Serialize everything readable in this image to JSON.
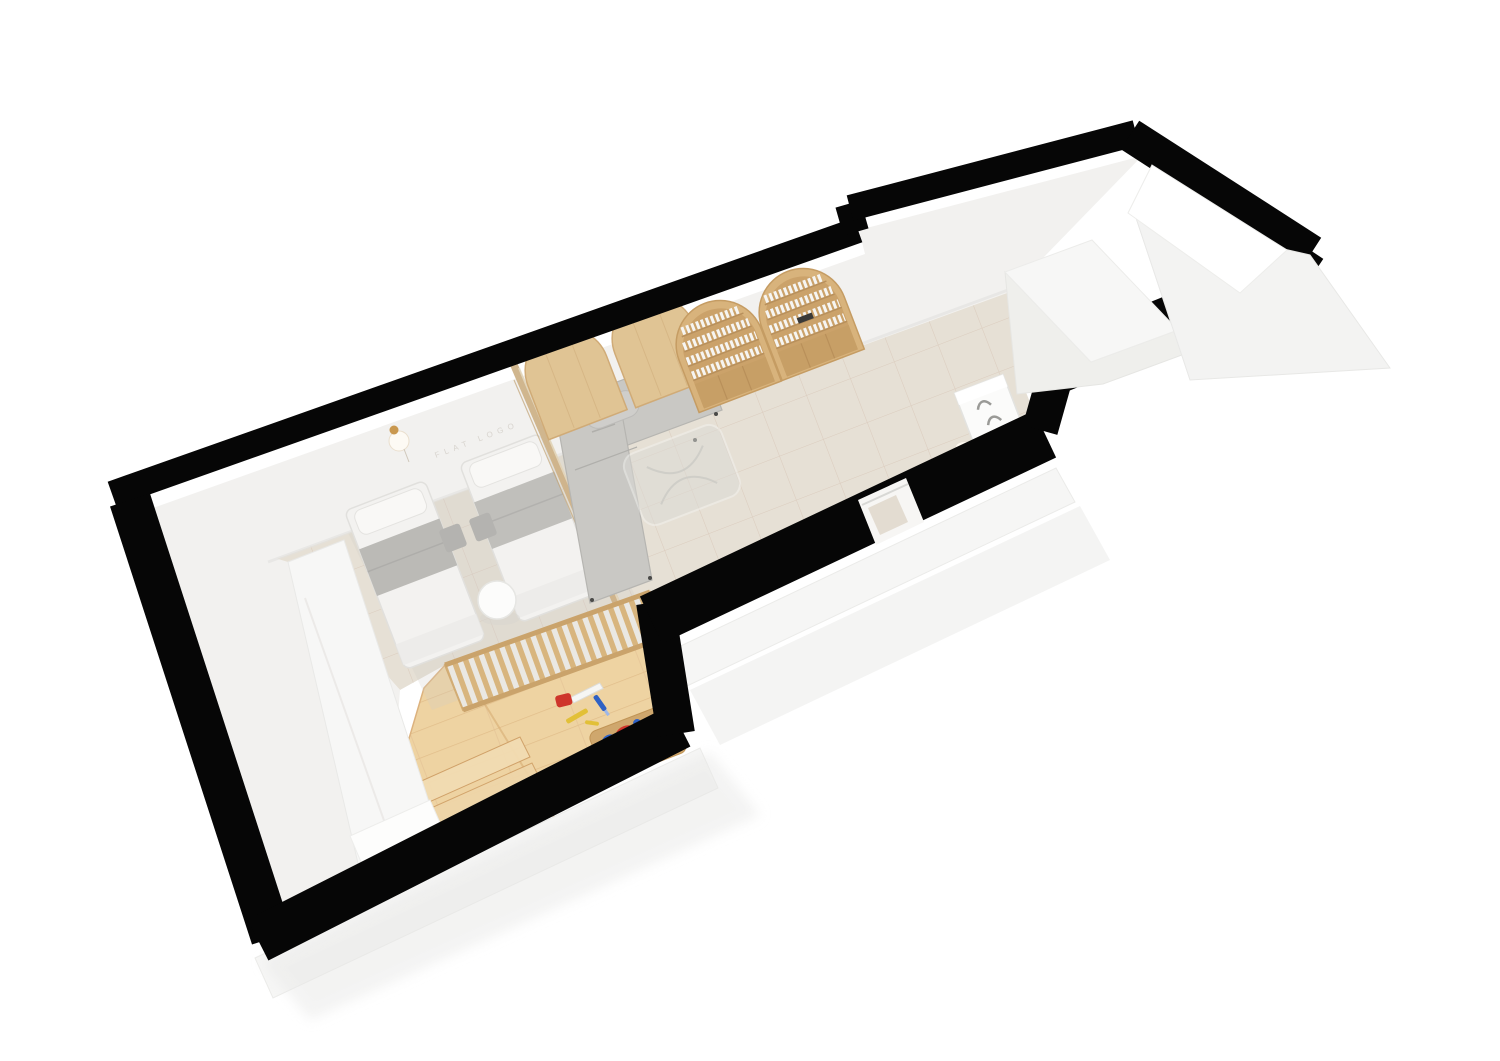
{
  "scene": {
    "type": "3d-floorplan-top-view-render",
    "description": "Isometric top-down 3D render of a long narrow studio apartment, rotated diagonally on a white background",
    "wall_label": "FLAT LOGO",
    "rotation_deg": -21,
    "colors": {
      "wall_black": "#060606",
      "wall_face": "#f2f1ef",
      "wall_face_bright": "#f7f7f6",
      "floor_tile": "#e6e0d5",
      "tile_grout": "#d5c2b2",
      "wood_floor": "#eed3a2",
      "wood_plank_line": "#ddb883",
      "wood_panel": "#e0c494",
      "wood_shelf": "#d8b37c",
      "wood_frame": "#cdb288",
      "sofa_gray": "#c9c8c4",
      "bed_white": "#f3f2f0",
      "blanket_gray": "#bbbab6",
      "pouf_gray": "#b4b3b0",
      "glass": "#dcdbd6",
      "brass": "#c9984f",
      "toy_red": "#ce352b",
      "toy_blue": "#2f61c4",
      "toy_green": "#3c9b42",
      "toy_yellow": "#e2c038",
      "toy_wood": "#cfa76d",
      "appliance_white": "#fbfbfa"
    },
    "rooms": [
      {
        "name": "bedroom",
        "floor": "tile",
        "items": [
          "single-bed",
          "single-bed",
          "round-side-table",
          "wall-lamp",
          "wardrobe",
          "floor-pouf",
          "floor-pouf"
        ]
      },
      {
        "name": "play-area",
        "floor": "wood",
        "items": [
          "slatted-canopy",
          "wood-platform-steps",
          "toy-board-with-rings",
          "toy-saw",
          "toy-tools"
        ]
      },
      {
        "name": "living-area",
        "floor": "tile",
        "items": [
          "glass-wood-partition",
          "l-shaped-sofa",
          "arched-wall-panel",
          "arched-wall-panel",
          "arched-bookshelf",
          "arched-bookshelf",
          "glass-coffee-table",
          "doorway"
        ]
      },
      {
        "name": "corridor",
        "floor": "tile",
        "items": [
          "washer-cabinet",
          "white-storage-volume"
        ]
      },
      {
        "name": "balcony-void",
        "floor": "none",
        "items": []
      }
    ],
    "counts": {
      "beds": 2,
      "arched_bookshelves": 2,
      "arched_panels": 2,
      "toy_rings": 6
    }
  }
}
